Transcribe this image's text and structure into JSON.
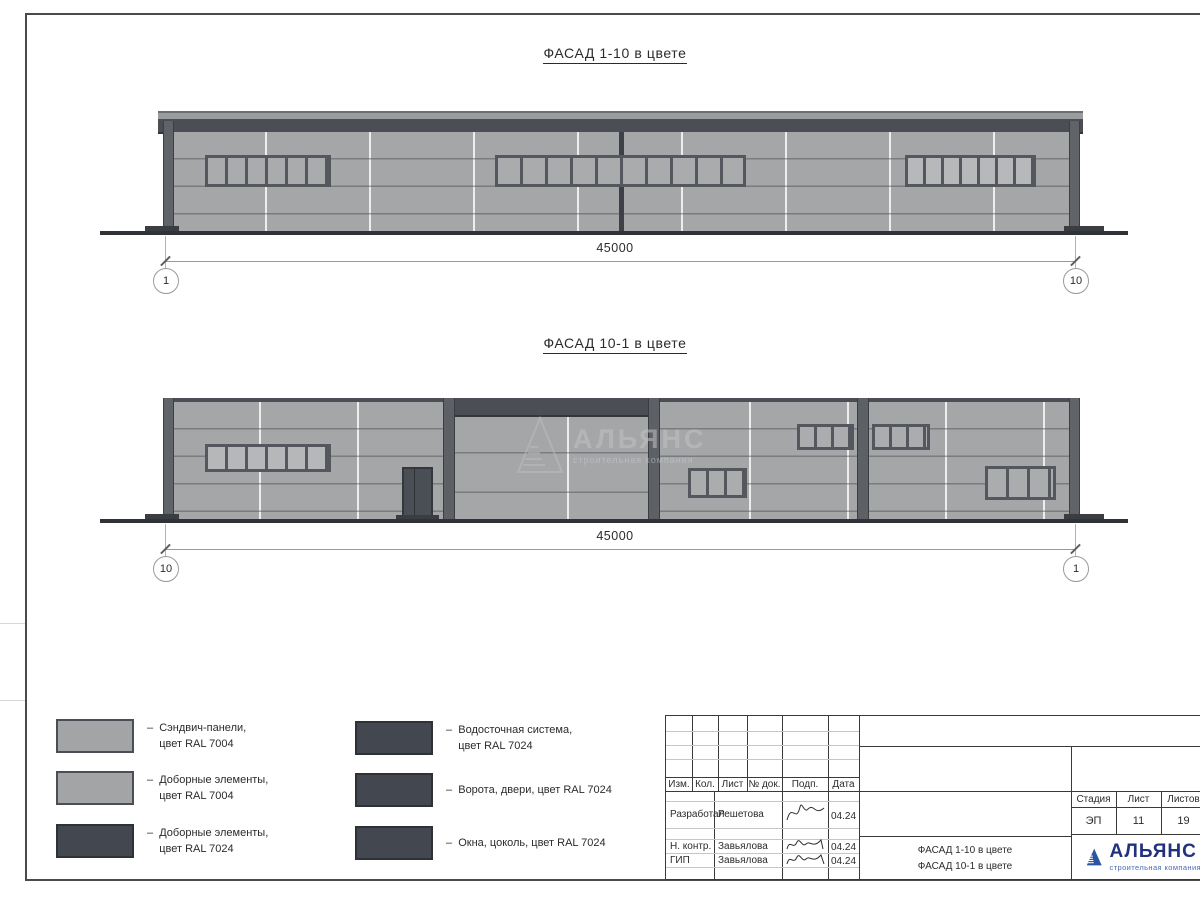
{
  "drawing": {
    "facade_top": {
      "title": "ФАСАД 1-10 в цвете",
      "dimension_mm": "45000",
      "axis_marker_left": "1",
      "axis_marker_right": "10"
    },
    "facade_bottom": {
      "title": "ФАСАД 10-1 в цвете",
      "dimension_mm": "45000",
      "axis_marker_left": "10",
      "axis_marker_right": "1",
      "watermark_name": "АЛЬЯНС",
      "watermark_tagline": "строительная компания"
    }
  },
  "legend": {
    "col1": [
      {
        "label": "–  Сэндвич-панели,\n    цвет RAL 7004",
        "swatch_color": "#a3a4a6"
      },
      {
        "label": "–  Доборные элементы,\n    цвет RAL 7004",
        "swatch_color": "#a3a4a6"
      },
      {
        "label": "–  Доборные элементы,\n    цвет RAL 7024",
        "swatch_color": "#43474f"
      }
    ],
    "col2": [
      {
        "label": "–  Водосточная система,\n    цвет RAL 7024",
        "swatch_color": "#43474f"
      },
      {
        "label": "–  Ворота, двери, цвет RAL 7024",
        "swatch_color": "#43474f"
      },
      {
        "label": "–  Окна, цоколь, цвет RAL 7024",
        "swatch_color": "#43474f"
      }
    ]
  },
  "titleblock": {
    "rev_headers": [
      "Изм.",
      "Кол.",
      "Лист",
      "№ док.",
      "Подп.",
      "Дата"
    ],
    "sign_rows": [
      {
        "role": "Разработал",
        "name": "Решетова",
        "date": "04.24"
      },
      {
        "role": "Н. контр.",
        "name": "Завьялова",
        "date": "04.24"
      },
      {
        "role": "ГИП",
        "name": "Завьялова",
        "date": "04.24"
      }
    ],
    "stage_headers": [
      "Стадия",
      "Лист",
      "Листов"
    ],
    "stage_values": [
      "ЭП",
      "11",
      "19"
    ],
    "doc_name": "ФАСАД 1-10 в цвете\nФАСАД 10-1 в цвете",
    "logo_name": "АЛЬЯНС",
    "logo_tagline": "строительная компания"
  },
  "colors": {
    "panel_ral7004": "#a3a4a6",
    "dark_ral7024": "#43474f",
    "frame_line": "#4a4a4a",
    "logo_blue": "#2a55a5",
    "logo_text_navy": "#22317d",
    "logo_tagline_blue": "#4a6ab5"
  }
}
